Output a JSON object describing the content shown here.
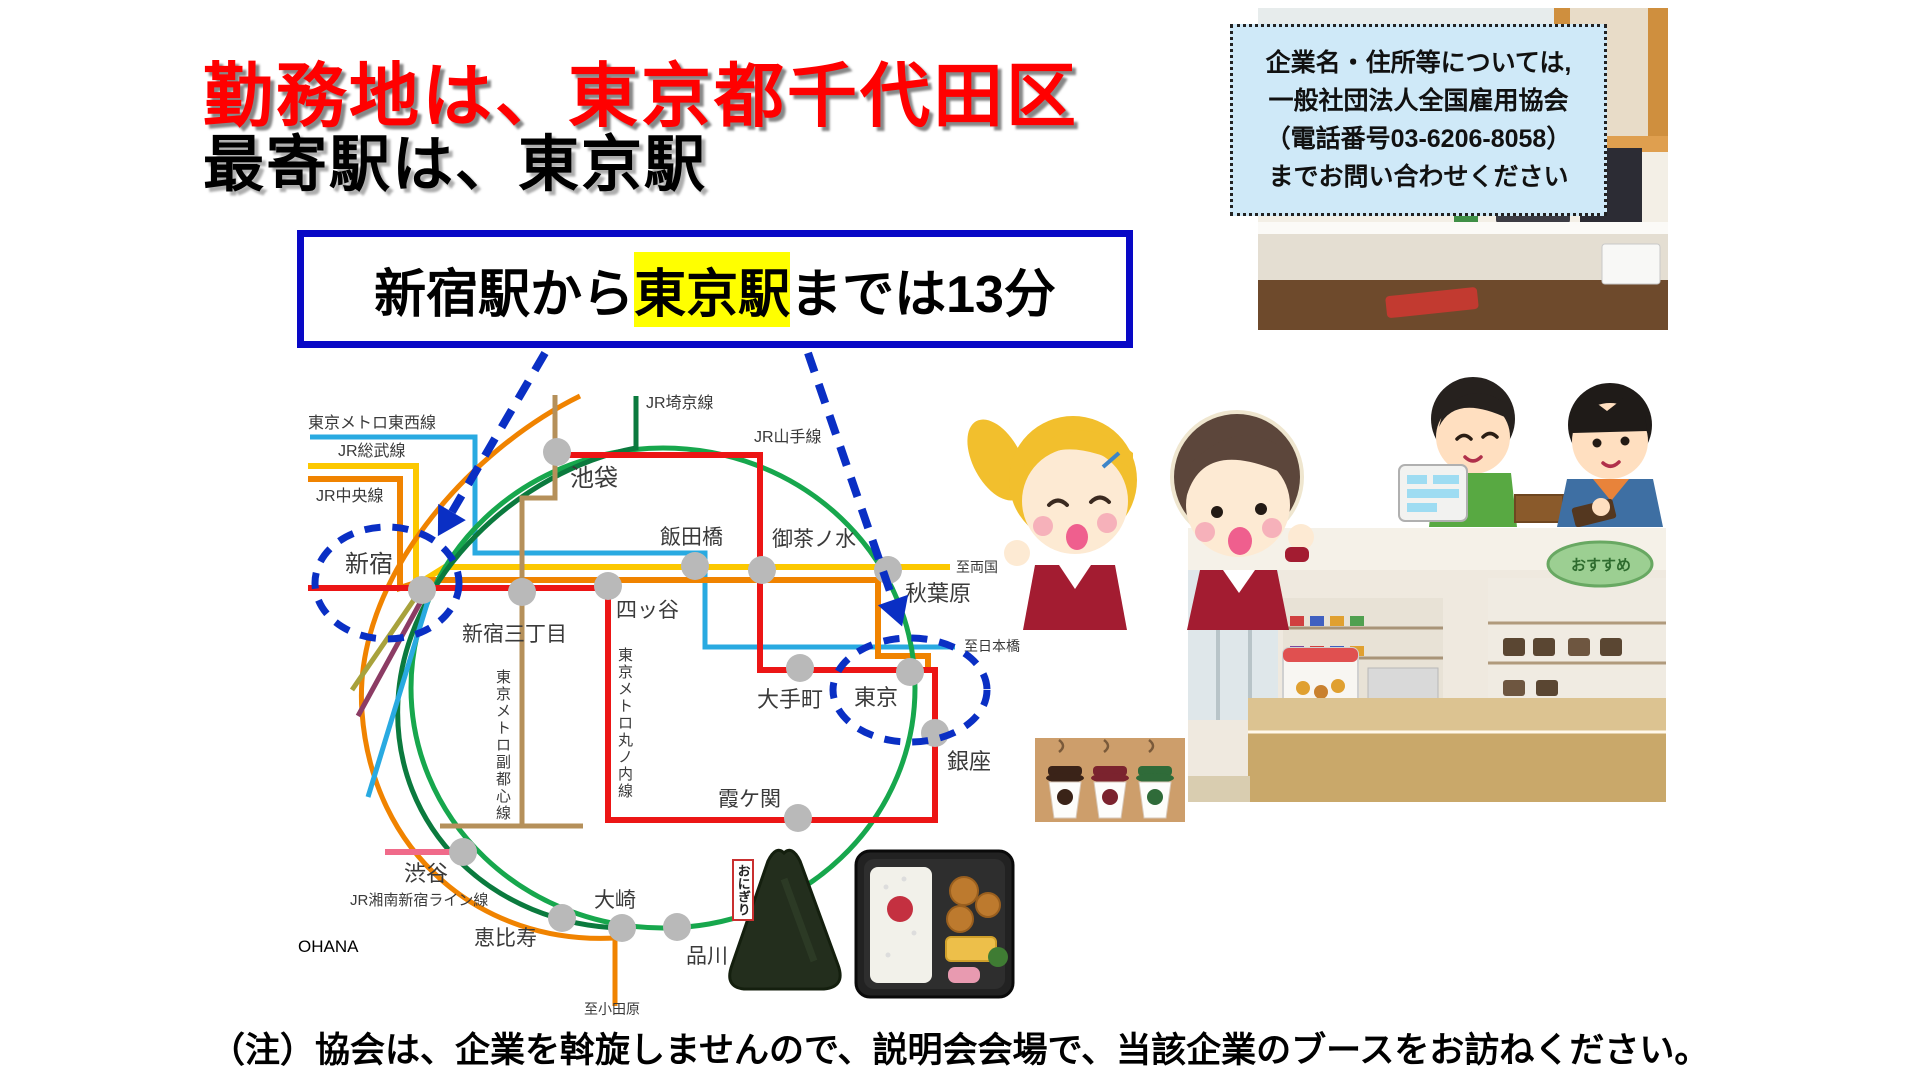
{
  "title": {
    "line1": "勤務地は、東京都千代田区",
    "line2": "最寄駅は、東京駅"
  },
  "transfer_box": {
    "prefix": "新宿駅から",
    "highlight": "東京駅",
    "suffix": "までは13分"
  },
  "contact_box": {
    "line1": "企業名・住所等については,",
    "line2": "一般社団法人全国雇用協会",
    "line3": "（電話番号03-6206-8058）",
    "line4": "までお問い合わせください"
  },
  "footnote": "（注）協会は、企業を斡旋しませんので、説明会会場で、当該企業のブースをお訪ねください。",
  "photos": {
    "store_sign": "おすすめ",
    "onigiri_tag": "おにぎり"
  },
  "colors": {
    "title_red": "#ff0000",
    "box_border_blue": "#0808c6",
    "highlight_yellow": "#ffff00",
    "contact_bg": "#cfe9f8",
    "dashed_blue": "#0a2fc4",
    "station_gray": "#b9b9b9"
  },
  "map": {
    "watermark": "OHANA",
    "station_color": "#b9b9b9",
    "label_color": "#3a3a3a",
    "lines": [
      {
        "name": "tokyo-metro-tozai",
        "color": "#29aae1",
        "width": 5,
        "path": "M310,437 L475,437 L475,553 L705,553 L705,647 L955,647"
      },
      {
        "name": "jr-sobu",
        "color": "#fcc800",
        "width": 6,
        "path": "M308,466 L416,466 L416,585 L445,567 L950,567"
      },
      {
        "name": "jr-chuo",
        "color": "#f08300",
        "width": 6,
        "path": "M308,479 L400,479 L400,588 L425,580 L878,580 L878,656 L928,656 L928,668"
      },
      {
        "name": "jr-yamanote",
        "color": "#17a74d",
        "width": 5,
        "type": "ellipse",
        "cx": 663,
        "cy": 688,
        "rx": 252,
        "ry": 240
      },
      {
        "name": "jr-saikyo",
        "color": "#0b7a3e",
        "width": 5,
        "path": "M636,396 L636,448 C520,470 405,575 398,700 C391,830 495,925 622,928"
      },
      {
        "name": "jr-shonan-shinjuku",
        "color": "#f08300",
        "width": 5,
        "path": "M580,396 C470,450 352,580 362,712 C372,852 480,945 615,938 L615,1006"
      },
      {
        "name": "tokyo-metro-marunouchi",
        "color": "#ec1515",
        "width": 6,
        "path": "M308,588 L608,588 L608,820 L935,820 L935,670 L760,670 L760,455 L557,455"
      },
      {
        "name": "tokyo-metro-fukutoshin",
        "color": "#b5905a",
        "width": 5,
        "path": "M555,395 L555,498 L522,498 L522,826 M440,826 L583,826"
      },
      {
        "name": "pink-stub",
        "color": "#f06a8a",
        "width": 6,
        "path": "M385,852 L452,852"
      },
      {
        "name": "olive-stub",
        "color": "#a8a23c",
        "width": 5,
        "path": "M422,588 L352,690"
      },
      {
        "name": "purple-stub",
        "color": "#8c3c64",
        "width": 5,
        "path": "M426,592 L358,716"
      },
      {
        "name": "lightblue-stub",
        "color": "#29aae1",
        "width": 5,
        "path": "M430,594 L368,797"
      }
    ],
    "stations": [
      {
        "id": "ikebukuro",
        "x": 557,
        "y": 452,
        "label": "池袋",
        "lx": 570,
        "ly": 486,
        "fs": 24
      },
      {
        "id": "shinjuku",
        "x": 422,
        "y": 590,
        "label": "新宿",
        "lx": 345,
        "ly": 572,
        "fs": 24
      },
      {
        "id": "shinjuku-sanchome",
        "x": 522,
        "y": 592,
        "label": "新宿三丁目",
        "lx": 462,
        "ly": 641,
        "fs": 21
      },
      {
        "id": "yotsuya",
        "x": 608,
        "y": 586,
        "label": "四ッ谷",
        "lx": 616,
        "ly": 617,
        "fs": 21
      },
      {
        "id": "iidabashi",
        "x": 695,
        "y": 566,
        "label": "飯田橋",
        "lx": 660,
        "ly": 544,
        "fs": 21
      },
      {
        "id": "ochanomizu",
        "x": 762,
        "y": 570,
        "label": "御茶ノ水",
        "lx": 772,
        "ly": 546,
        "fs": 21
      },
      {
        "id": "akihabara",
        "x": 888,
        "y": 570,
        "label": "秋葉原",
        "lx": 905,
        "ly": 601,
        "fs": 22
      },
      {
        "id": "otemachi",
        "x": 800,
        "y": 668,
        "label": "大手町",
        "lx": 757,
        "ly": 707,
        "fs": 22
      },
      {
        "id": "tokyo",
        "x": 910,
        "y": 672,
        "label": "東京",
        "lx": 854,
        "ly": 705,
        "fs": 22
      },
      {
        "id": "ginza",
        "x": 935,
        "y": 733,
        "label": "銀座",
        "lx": 947,
        "ly": 769,
        "fs": 22
      },
      {
        "id": "kasumigaseki",
        "x": 798,
        "y": 818,
        "label": "霞ケ関",
        "lx": 718,
        "ly": 806,
        "fs": 21
      },
      {
        "id": "shibuya",
        "x": 463,
        "y": 852,
        "label": "渋谷",
        "lx": 404,
        "ly": 881,
        "fs": 22
      },
      {
        "id": "ebisu",
        "x": 562,
        "y": 918,
        "label": "恵比寿",
        "lx": 474,
        "ly": 945,
        "fs": 21
      },
      {
        "id": "osaki",
        "x": 622,
        "y": 928,
        "label": "大崎",
        "lx": 594,
        "ly": 907,
        "fs": 21
      },
      {
        "id": "shinagawa",
        "x": 677,
        "y": 927,
        "label": "品川",
        "lx": 686,
        "ly": 963,
        "fs": 21
      }
    ],
    "labels": [
      {
        "text": "東京メトロ東西線",
        "x": 308,
        "y": 428,
        "fs": 16
      },
      {
        "text": "JR総武線",
        "x": 338,
        "y": 456,
        "fs": 16
      },
      {
        "text": "JR中央線",
        "x": 316,
        "y": 501,
        "fs": 16
      },
      {
        "text": "JR埼京線",
        "x": 646,
        "y": 408,
        "fs": 16
      },
      {
        "text": "JR山手線",
        "x": 754,
        "y": 442,
        "fs": 16
      },
      {
        "text": "JR湘南新宿ライン線",
        "x": 350,
        "y": 905,
        "fs": 15
      },
      {
        "text": "東京メトロ丸ノ内線",
        "x": 618,
        "y": 660,
        "fs": 15,
        "vertical": true
      },
      {
        "text": "東京メトロ副都心線",
        "x": 496,
        "y": 682,
        "fs": 15,
        "vertical": true
      },
      {
        "text": "至両国",
        "x": 956,
        "y": 572,
        "fs": 14
      },
      {
        "text": "至日本橋",
        "x": 964,
        "y": 651,
        "fs": 14
      },
      {
        "text": "至小田原",
        "x": 584,
        "y": 1014,
        "fs": 14
      },
      {
        "text": "OHANA",
        "x": 298,
        "y": 952,
        "fs": 17,
        "color": "#000"
      }
    ],
    "highlight_ellipses": [
      {
        "id": "shinjuku-circle",
        "cx": 387,
        "cy": 583,
        "rx": 72,
        "ry": 56
      },
      {
        "id": "tokyo-circle",
        "cx": 910,
        "cy": 690,
        "rx": 77,
        "ry": 52
      }
    ],
    "arrows": [
      {
        "id": "arrow-to-shinjuku",
        "x1": 545,
        "y1": 353,
        "x2": 452,
        "y2": 512
      },
      {
        "id": "arrow-to-tokyo",
        "x1": 808,
        "y1": 353,
        "x2": 893,
        "y2": 600
      }
    ]
  }
}
